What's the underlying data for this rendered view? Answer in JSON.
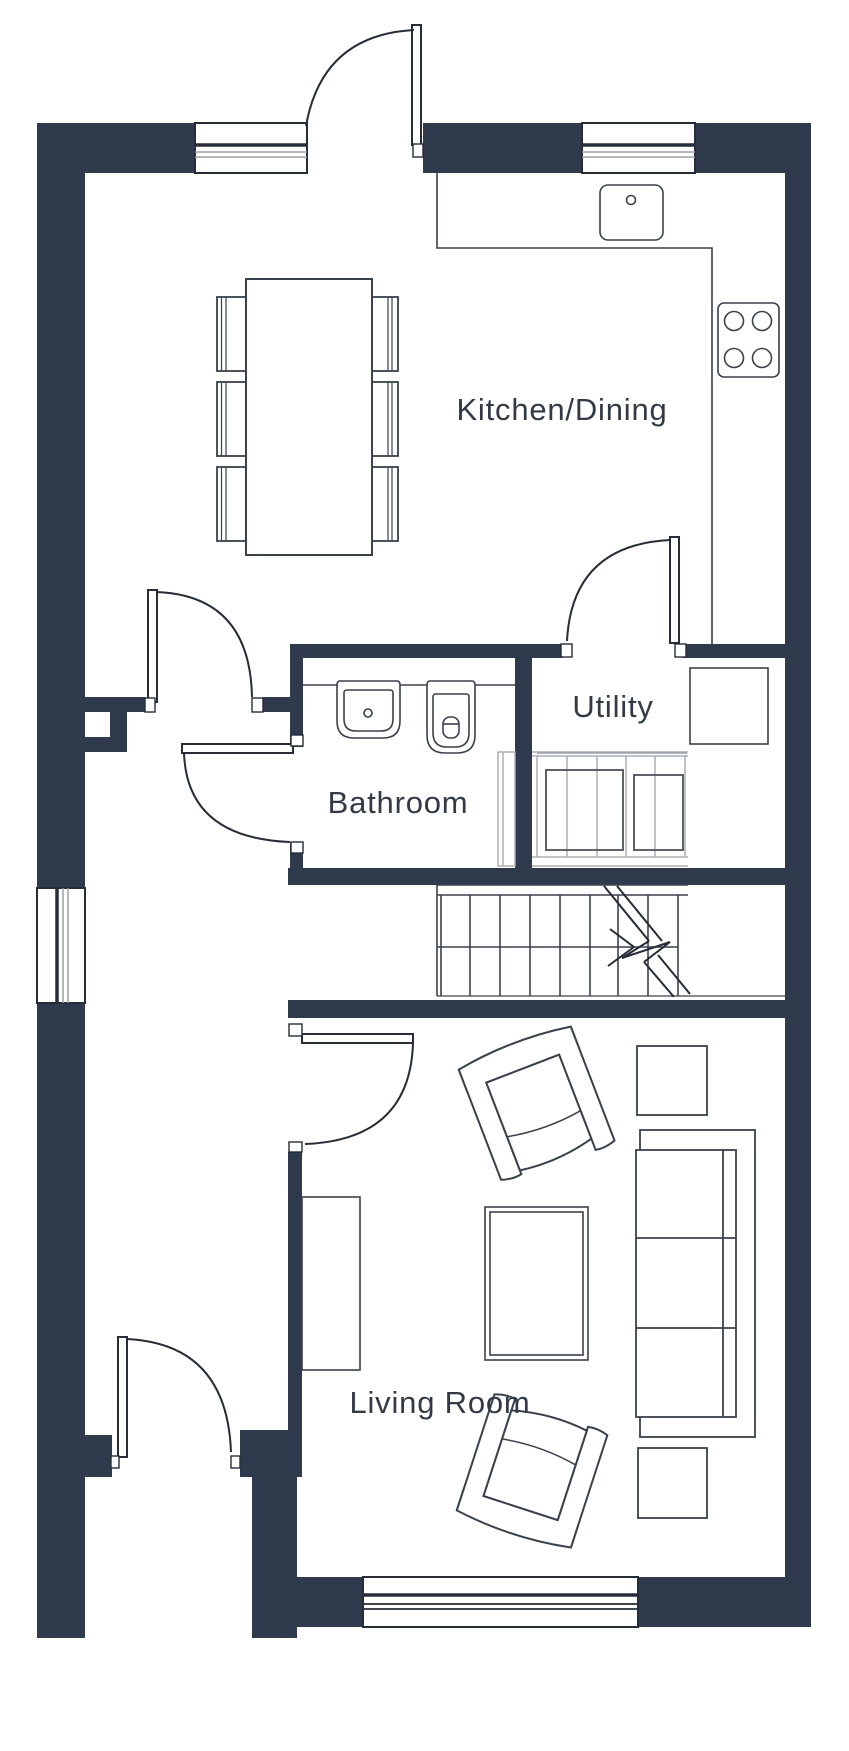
{
  "plan": {
    "type": "floor-plan",
    "floor": "ground",
    "background": "#FFFFFF"
  },
  "colors": {
    "wall": "#2F3A4C",
    "door_line": "#262D38",
    "furniture_line": "#3A414C",
    "cabinet_line_light": "#ABAFB6",
    "cabinet_line_mid": "#9BA0A7",
    "appliance_line": "#4C525C",
    "label_text": "#333A46"
  },
  "rooms": {
    "kitchen_dining": {
      "label": "Kitchen/Dining",
      "fixtures": [
        "sink",
        "hob",
        "worktop",
        "dining-table",
        "dining-chair",
        "dining-chair",
        "dining-chair",
        "dining-chair",
        "dining-chair",
        "dining-chair",
        "window",
        "window",
        "external-door"
      ]
    },
    "bathroom": {
      "label": "Bathroom",
      "fixtures": [
        "basin",
        "toilet",
        "counter",
        "cupboard",
        "door"
      ]
    },
    "utility": {
      "label": "Utility",
      "fixtures": [
        "appliance-cupboard",
        "washing-machine",
        "washing-machine",
        "worktop",
        "door"
      ]
    },
    "living_room": {
      "label": "Living Room",
      "fixtures": [
        "sofa",
        "armchair",
        "armchair",
        "coffee-table",
        "side-table",
        "side-table",
        "tv-unit",
        "window",
        "door"
      ]
    },
    "hall": {
      "label": "",
      "fixtures": [
        "front-door",
        "staircase",
        "window"
      ]
    }
  },
  "stairs": {
    "direction": "up",
    "symbol": "break-line-with-arrow",
    "treads_visible": 8
  }
}
